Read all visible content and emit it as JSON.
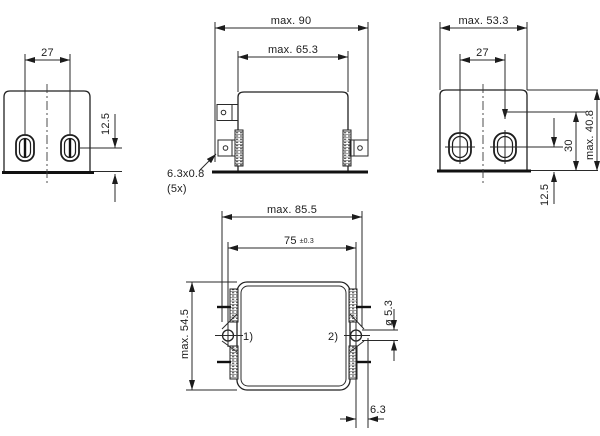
{
  "drawing": {
    "view_side_left": {
      "hole_spacing": "27",
      "hole_height": "12.5"
    },
    "view_front": {
      "overall_width": "max. 90",
      "body_width": "max. 65.3",
      "terminal_note_line1": "6.3x0.8",
      "terminal_note_line2": "(5x)"
    },
    "view_side_right": {
      "overall_width": "max. 53.3",
      "hole_spacing": "27",
      "overall_height": "max. 40.8",
      "slot_height": "30",
      "hole_height": "12.5"
    },
    "view_top": {
      "overall_width": "max. 85.5",
      "mount_spacing": "75",
      "mount_tolerance": "±0.3",
      "overall_depth": "max. 54.5",
      "mount_hole_diameter": "ø 5.3",
      "edge_offset": "6.3",
      "ref_1": "1)",
      "ref_2": "2)"
    },
    "colors": {
      "line": "#222222",
      "background": "#ffffff"
    }
  }
}
